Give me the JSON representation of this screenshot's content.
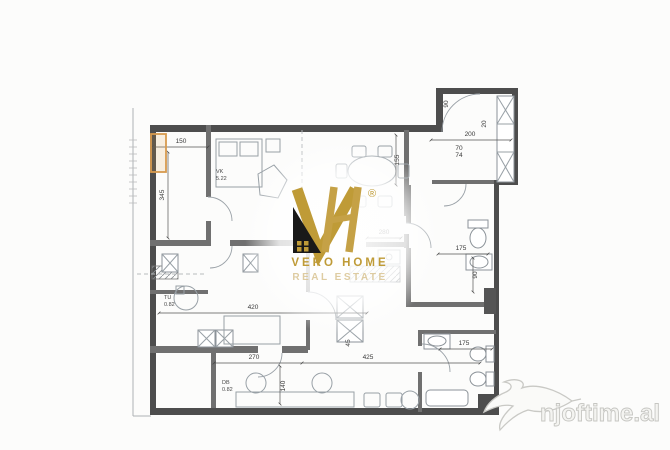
{
  "brand": {
    "name_line1": "VERO HOME",
    "name_line2": "REAL ESTATE",
    "registered_mark": "®",
    "colors": {
      "gold": "#bf9b37",
      "gold_light": "#d9c493",
      "black": "#191919"
    }
  },
  "site_watermark": {
    "text": "njoftime.al",
    "color": "#dadad6"
  },
  "floorplan": {
    "highlight_color": "#d79a4e",
    "dimensions": [
      {
        "label": "150"
      },
      {
        "label": "345"
      },
      {
        "label": "155"
      },
      {
        "label": "200"
      },
      {
        "label": "70"
      },
      {
        "label": "74"
      },
      {
        "label": "90"
      },
      {
        "label": "20"
      },
      {
        "label": "280"
      },
      {
        "label": "175"
      },
      {
        "label": "90"
      },
      {
        "label": "420"
      },
      {
        "label": "270"
      },
      {
        "label": "425"
      },
      {
        "label": "140"
      },
      {
        "label": "175"
      },
      {
        "label": "45"
      }
    ],
    "room_tags": [
      {
        "code": "VK",
        "area": "5.22"
      },
      {
        "code": "TU",
        "area": "0.82"
      },
      {
        "code": "DB",
        "area": "0.82"
      }
    ]
  }
}
